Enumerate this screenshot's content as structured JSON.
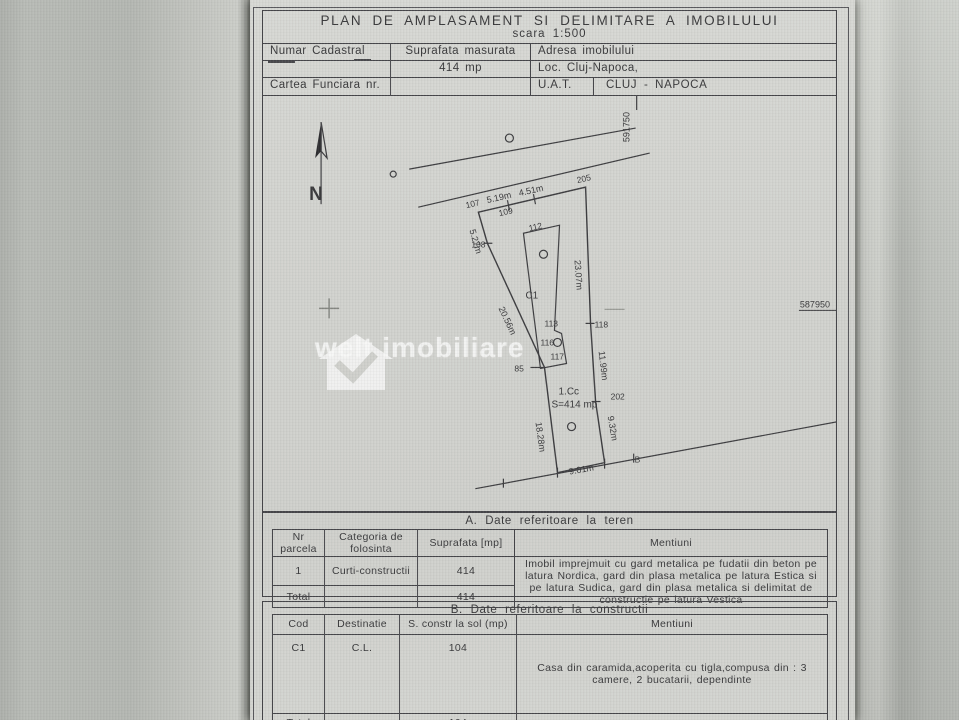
{
  "page": {
    "title": "PLAN DE AMPLASAMENT SI DELIMITARE A IMOBILULUI",
    "scale": "scara 1:500"
  },
  "info": {
    "numar_cadastral": "Numar Cadastral",
    "suprafata_masurata": "Suprafata masurata",
    "adresa": "Adresa imobilului",
    "suprafata_value": "414 mp",
    "localitate": "Loc. Cluj-Napoca,",
    "cartea_funciara": "Cartea Funciara nr.",
    "uat_label": "U.A.T.",
    "uat_value": "CLUJ - NAPOCA"
  },
  "plan": {
    "north": "N",
    "coord_top": "591750",
    "coord_right": "587950",
    "zone": "1.Cc",
    "area": "S=414 mp",
    "building": "C1",
    "watermark": "welt imobiliare",
    "points": {
      "p107": "107",
      "p108": "108",
      "p109": "109",
      "p112": "112",
      "p113": "113",
      "p116": "116",
      "p117": "117",
      "p118": "118",
      "p202": "202",
      "p205": "205",
      "p85": "85",
      "pB": "B"
    },
    "dims": {
      "top1": "5.19m",
      "top2": "4.51m",
      "left1": "5.27m",
      "left2": "20.56m",
      "left3": "18.28m",
      "right1": "23.07m",
      "right2": "11.99m",
      "right3": "9.32m",
      "bottom": "9.01m"
    }
  },
  "table_a": {
    "title": "A. Date referitoare la teren",
    "headers": {
      "nr": "Nr parcela",
      "cat": "Categoria de folosinta",
      "sup": "Suprafata [mp]",
      "men": "Mentiuni"
    },
    "rows": [
      {
        "nr": "1",
        "cat": "Curti-constructii",
        "sup": "414",
        "men": "Imobil imprejmuit cu gard metalica pe fudatii din beton pe latura Nordica, gard din plasa metalica pe latura Estica si pe latura Sudica, gard din plasa metalica si delimitat de constructie pe latura Vestica"
      },
      {
        "nr": "Total",
        "cat": "",
        "sup": "414",
        "men": ""
      }
    ]
  },
  "table_b": {
    "title": "B. Date referitoare la constructii",
    "headers": {
      "cod": "Cod",
      "dest": "Destinatie",
      "sup": "S. constr la sol (mp)",
      "men": "Mentiuni"
    },
    "rows": [
      {
        "cod": "C1",
        "dest": "C.L.",
        "sup": "104",
        "men": "Casa din caramida,acoperita cu tigla,compusa din : 3 camere, 2 bucatarii, dependinte"
      },
      {
        "cod": "Total",
        "dest": "",
        "sup": "104",
        "men": ""
      }
    ]
  }
}
